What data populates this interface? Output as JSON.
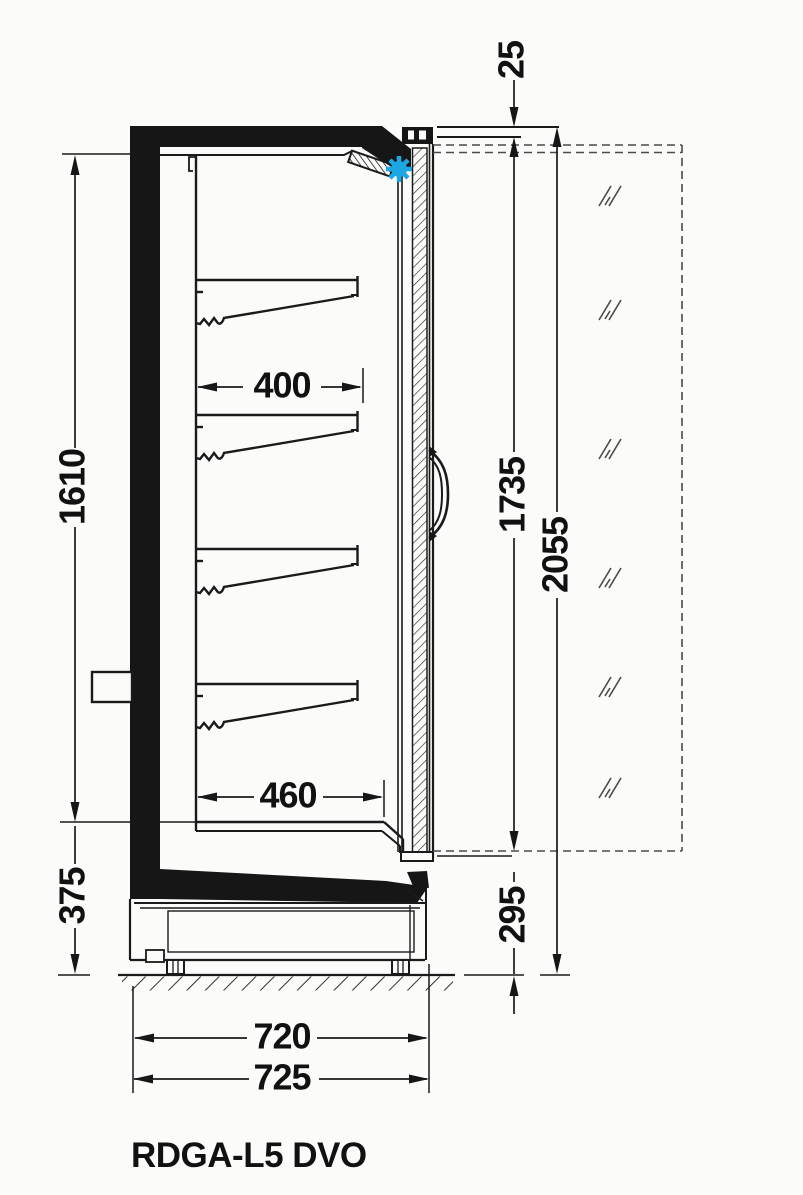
{
  "title": "RDGA-L5 DVO",
  "dimensions": {
    "top_offset": "25",
    "interior_height": "1610",
    "shelf_depth": "400",
    "door_glass_height": "1735",
    "overall_height": "2055",
    "bottom_shelf_depth": "460",
    "base_section_height": "375",
    "bottom_front_height": "295",
    "body_depth": "720",
    "overall_depth": "725"
  },
  "colors": {
    "accent_blue": "#1CA7E3",
    "line_black": "#1a1a1a",
    "background": "#fbfbfa"
  }
}
